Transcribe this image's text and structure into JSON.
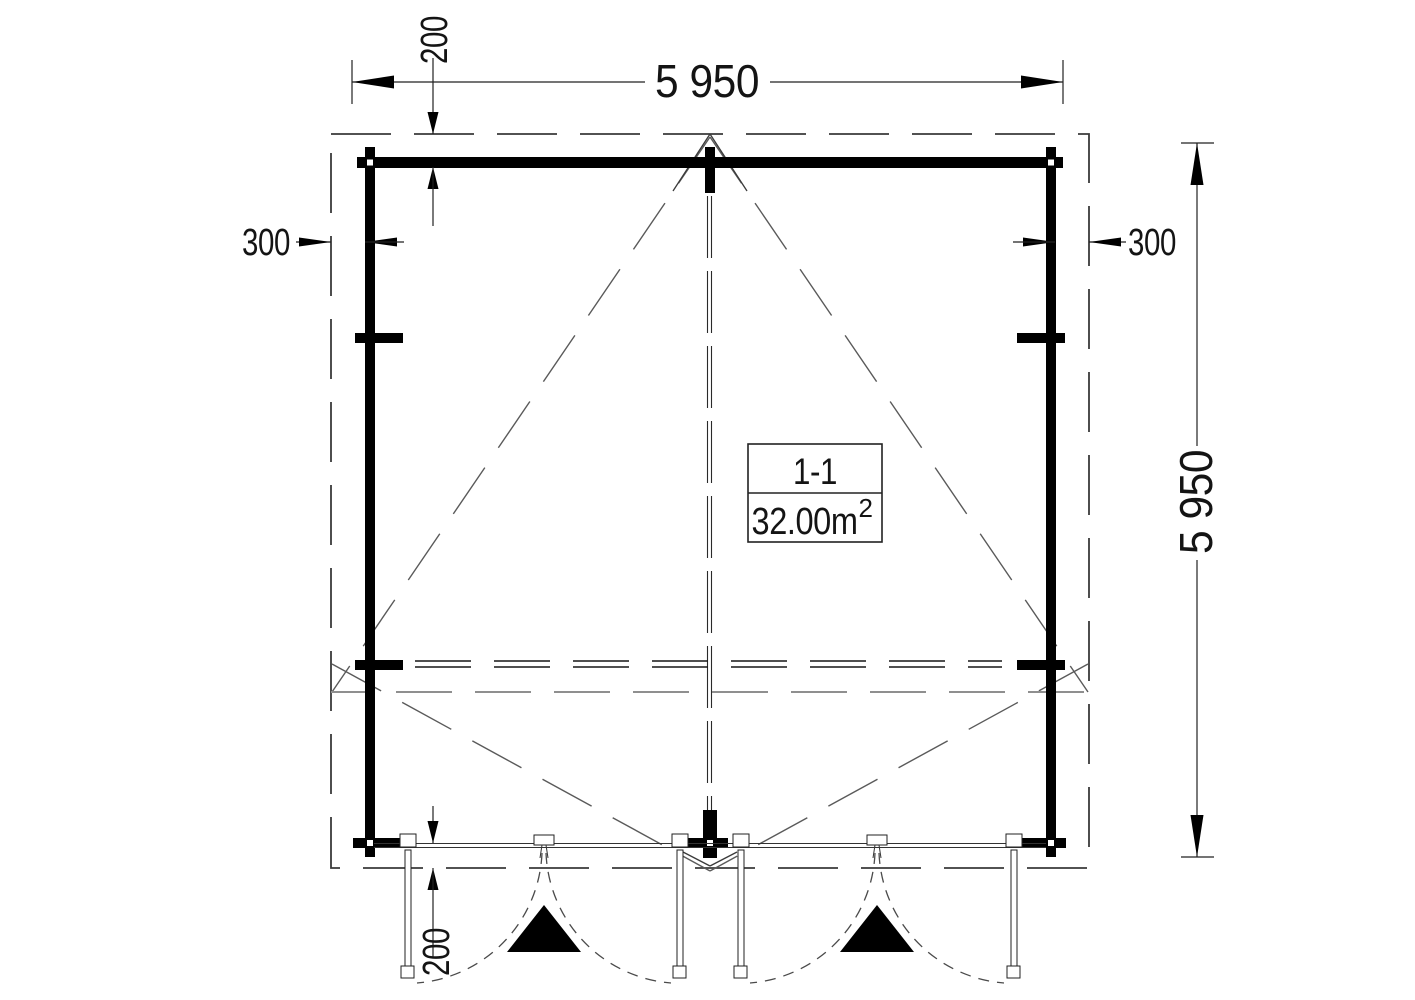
{
  "plan": {
    "room_label": {
      "name": "1-1",
      "area_value": "32.00m",
      "area_exponent": "2"
    },
    "dimensions": {
      "overall_width_mm": "5 950",
      "overall_height_mm": "5 950",
      "left_wall_inset_mm": "300",
      "right_wall_inset_mm": "300",
      "top_roof_overhang_mm": "200",
      "bottom_roof_overhang_mm": "200"
    },
    "colors": {
      "wall": "#000000",
      "dim_line": "#222222",
      "dashed_outline": "#3a3a3a",
      "diagonal": "#5a5a5a",
      "ridge": "#2a2a2a",
      "beam": "#161616",
      "eaves_gray": "#8f8f8f",
      "arc": "#4a4a4a",
      "background": "#ffffff"
    }
  }
}
